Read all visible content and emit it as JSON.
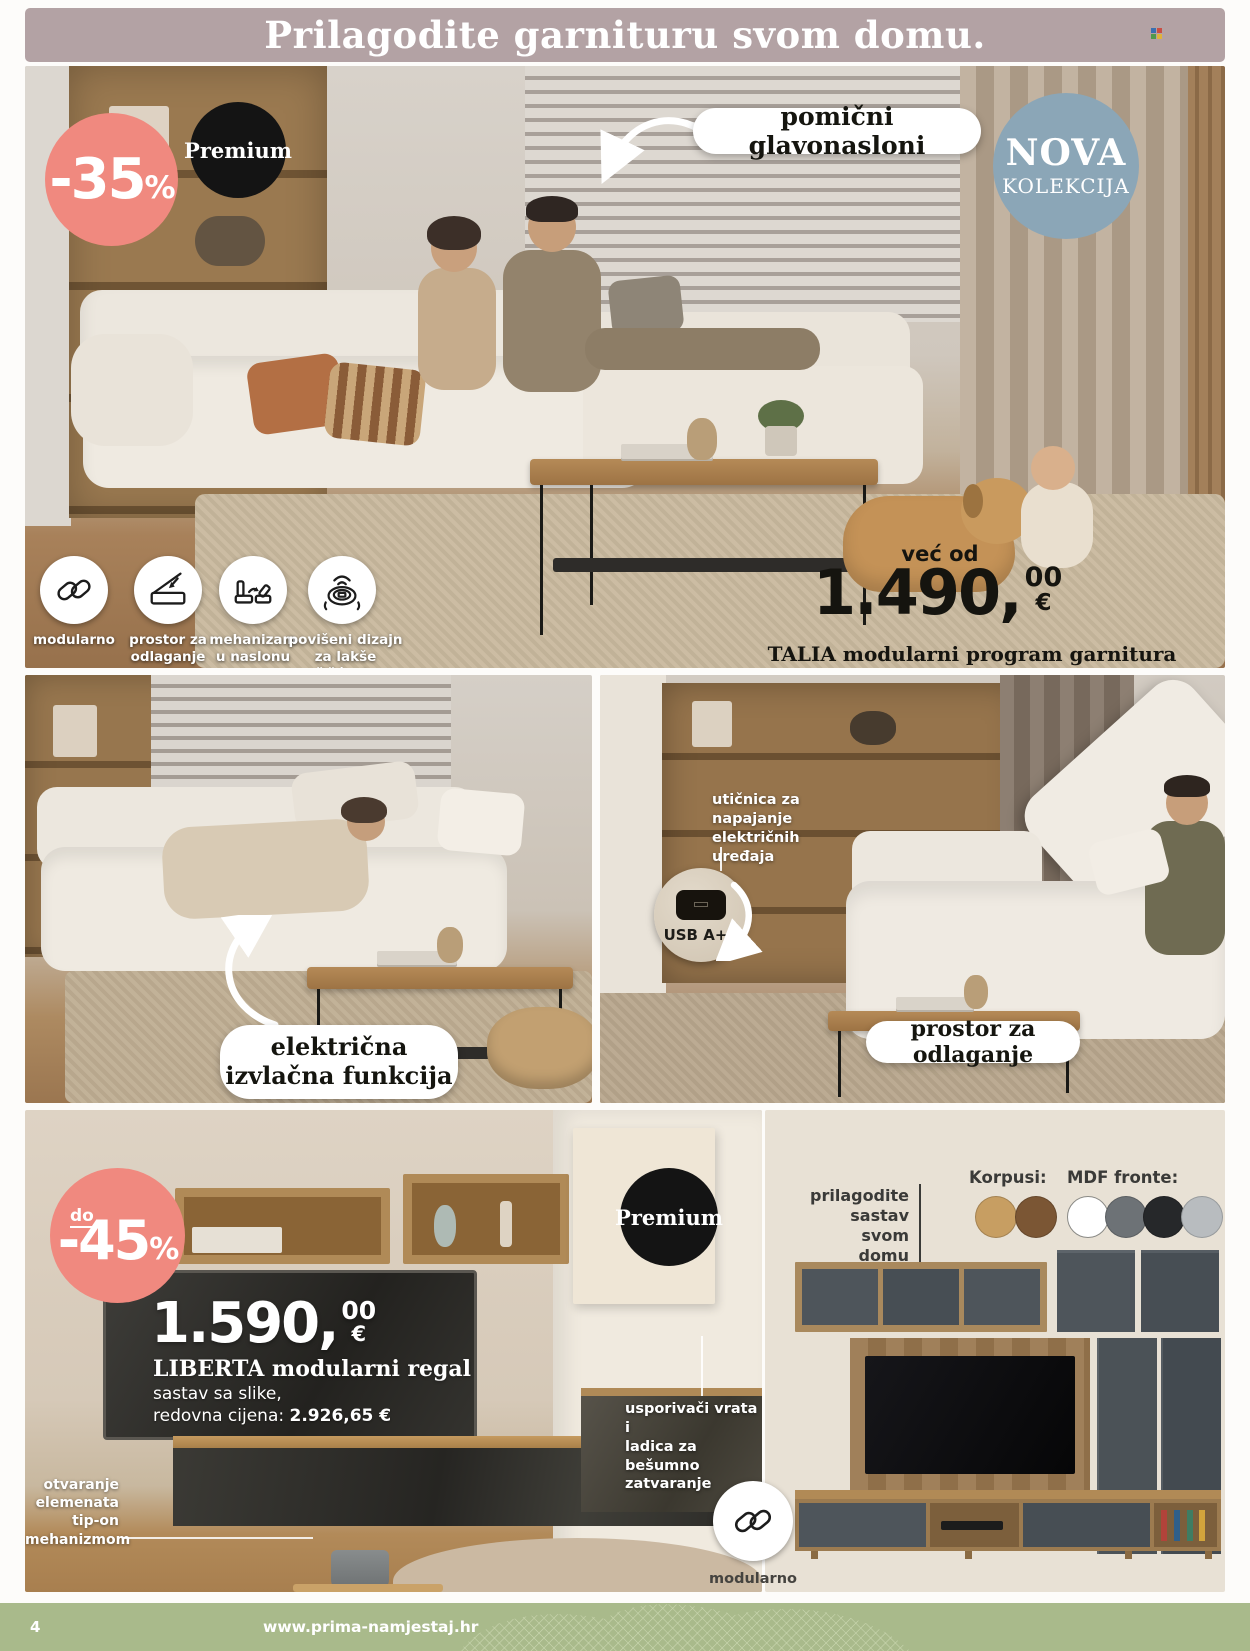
{
  "header": {
    "title": "Prilagodite garnituru svom domu."
  },
  "hero": {
    "discount_badge": {
      "value": "-35",
      "percent": "%"
    },
    "premium_badge": "Premium",
    "headrest_callout": "pomični glavonasloni",
    "new_collection": {
      "line1": "NOVA",
      "line2": "KOLEKCIJA"
    },
    "price": {
      "prefix": "već od",
      "amount": "1.490,",
      "cents": "00",
      "currency": "€"
    },
    "product_name": "TALIA modularni program garnitura",
    "features": [
      {
        "icon": "chain-link-icon",
        "label": "modularno"
      },
      {
        "icon": "storage-open-icon",
        "label": "prostor za\nodlaganje"
      },
      {
        "icon": "seat-mechanism-icon",
        "label": "mehanizam\nu naslonu"
      },
      {
        "icon": "robot-vacuum-icon",
        "label": "povišeni dizajn\nza lakše čišćenje"
      }
    ]
  },
  "middle": {
    "left_callout": "električna\nizvlačna funkcija",
    "socket_note": "utičnica za\nnapajanje\nelektričnih\nuređaja",
    "usb_label": "USB A+C",
    "right_callout": "prostor za odlaganje"
  },
  "bottom": {
    "discount_badge": {
      "prefix": "do",
      "value": "-45",
      "percent": "%"
    },
    "premium_badge": "Premium",
    "price": {
      "amount": "1.590,",
      "cents": "00",
      "currency": "€"
    },
    "product_name": "LIBERTA modularni regal",
    "config_line": "sastav sa slike,",
    "regular_price_label": "redovna cijena: ",
    "regular_price_value": "2.926,65 €",
    "tipon_note": "otvaranje\nelemenata\ntip-on\nmehanizmom",
    "softclose_note": "usporivači vrata i\nladica za bešumno\nzatvaranje",
    "modular_label": "modularno",
    "customize_note": "prilagodite\nsastav svom\ndomu",
    "korpusi_label": "Korpusi:",
    "mdf_label": "MDF fronte:",
    "korpusi_colors": [
      "#c79e62",
      "#7b5634"
    ],
    "mdf_colors": [
      "#ffffff",
      "#6d7276",
      "#26282a",
      "#b8bcbf"
    ]
  },
  "footer": {
    "page_number": "4",
    "website": "www.prima-namjestaj.hr"
  },
  "colors": {
    "accent_pink": "#f0897f",
    "badge_black": "#141414",
    "nova_blue": "#8ba6b7",
    "header_mauve": "#b3a2a4",
    "footer_green": "#a9ba8b",
    "panel_beige": "#e8e1d5"
  },
  "icons": {
    "feature_icons": [
      "chain-link-icon",
      "storage-open-icon",
      "seat-mechanism-icon",
      "robot-vacuum-icon"
    ],
    "usb_inset": "usb-port-icon",
    "modular_overlay": "chain-link-icon"
  }
}
